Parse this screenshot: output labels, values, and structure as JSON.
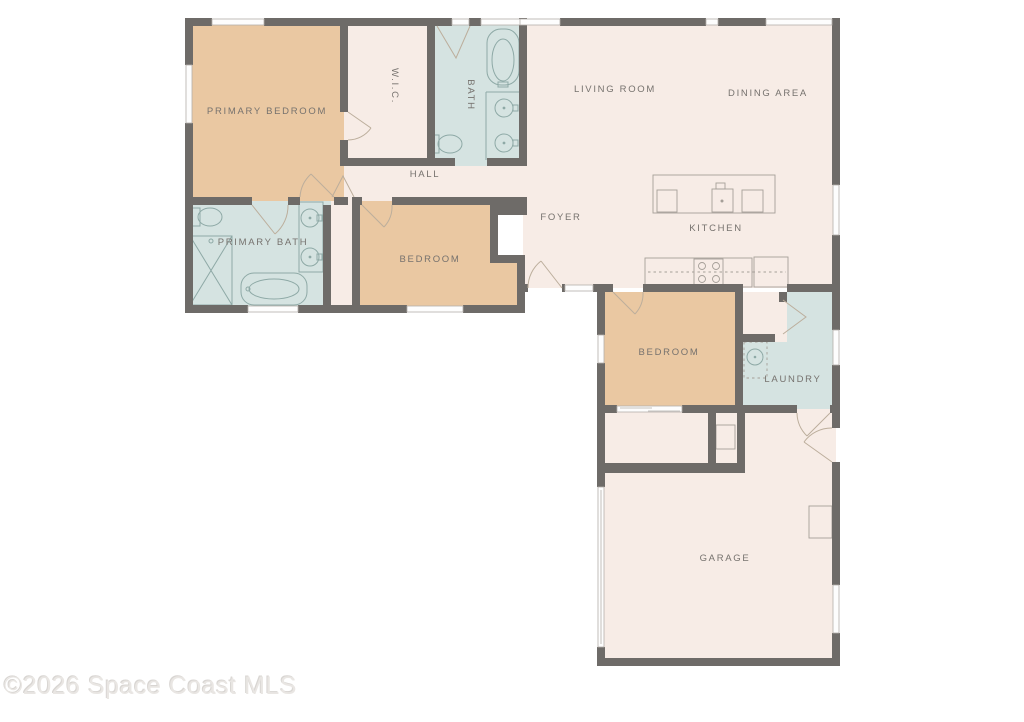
{
  "watermark_text": "©2026 Space Coast MLS",
  "palette": {
    "wall": "#6e6b68",
    "room_living": "#f7ece6",
    "room_bedroom": "#eac8a2",
    "room_bath": "#d5e3e1",
    "label_text": "#76726e",
    "fixture_line": "#8ea9a6",
    "counter_line": "#a59f98",
    "door_arc": "#bcae9c",
    "watermark": "#e9e6e3"
  },
  "floor_plan": {
    "rooms": [
      {
        "id": "primary-bedroom",
        "label": "PRIMARY BEDROOM"
      },
      {
        "id": "wic",
        "label": "W.I.C."
      },
      {
        "id": "bath",
        "label": "BATH"
      },
      {
        "id": "living-room",
        "label": "LIVING ROOM"
      },
      {
        "id": "dining-area",
        "label": "DINING AREA"
      },
      {
        "id": "hall",
        "label": "HALL"
      },
      {
        "id": "foyer",
        "label": "FOYER"
      },
      {
        "id": "kitchen",
        "label": "KITCHEN"
      },
      {
        "id": "primary-bath",
        "label": "PRIMARY BATH"
      },
      {
        "id": "bedroom-2",
        "label": "BEDROOM"
      },
      {
        "id": "bedroom-3",
        "label": "BEDROOM"
      },
      {
        "id": "laundry",
        "label": "LAUNDRY"
      },
      {
        "id": "garage",
        "label": "GARAGE"
      }
    ]
  }
}
